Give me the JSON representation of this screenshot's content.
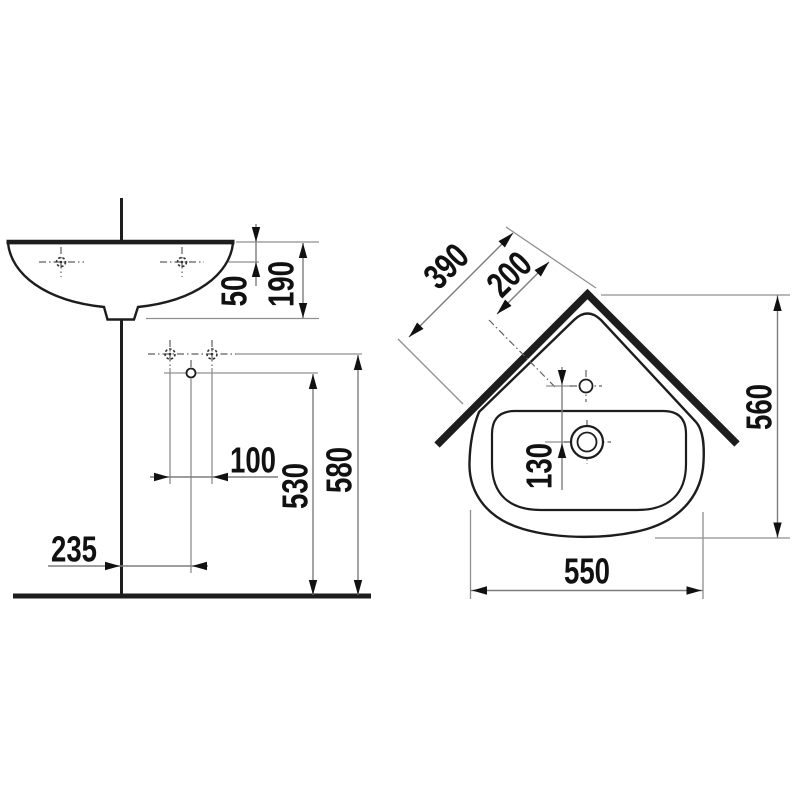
{
  "drawing": {
    "kind": "corner-washbasin-technical-drawing",
    "front_view": {
      "dims": {
        "rim_to_tap_hole": "50",
        "basin_height": "190",
        "fixing_hole_spacing": "100",
        "drain_height": "530",
        "fixing_holes_height": "580",
        "corner_to_drain_offset": "235"
      }
    },
    "top_view": {
      "dims": {
        "wall_edge_length": "390",
        "corner_to_tap_hole": "200",
        "tap_hole_to_drain": "130",
        "depth": "560",
        "width": "550"
      }
    },
    "colors": {
      "line": "#1d1d1d",
      "thin_line": "#8f8f8f",
      "background": "#ffffff"
    }
  }
}
